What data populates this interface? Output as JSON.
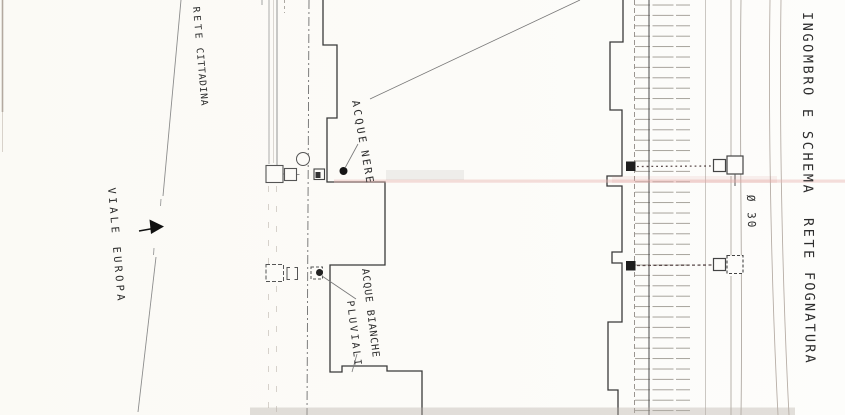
{
  "page": {
    "title_vertical": {
      "words": [
        "INGOMBRO",
        "E",
        "SCHEMA",
        "RETE",
        "FOGNATURA"
      ]
    },
    "labels": {
      "street": [
        "VIALE",
        "EUROPA"
      ],
      "city_network": [
        "RETE",
        "CITTADINA"
      ],
      "black_water": [
        "ACQUE",
        "NERE"
      ],
      "white_water": [
        "ACQUE BIANCHE",
        "PLUVIALI"
      ],
      "pipe_diameter": "Ø 30"
    },
    "colors": {
      "ink": "#2d2d2d",
      "building_outline": "#3a3a3a",
      "faint_line": "#b0a9a2",
      "artifact_pink": "#e8b6b2",
      "paper": "#fcfbf8"
    }
  }
}
